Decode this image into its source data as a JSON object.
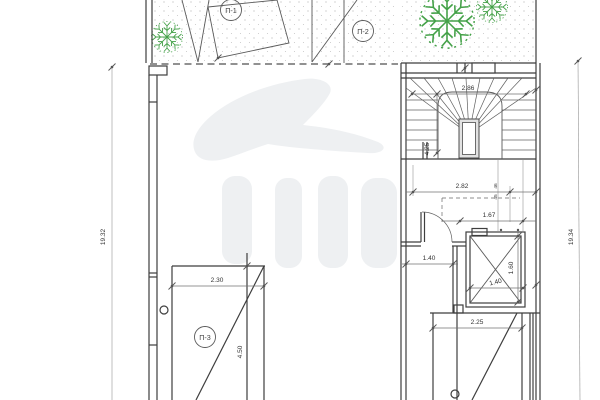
{
  "plan": {
    "title": "Architectural floor plan with winder stair, elevator shaft and garden areas",
    "labels": {
      "area1": "П-1",
      "area2": "П-2",
      "area3": "П-3"
    },
    "dims": {
      "stair_width": "2.86",
      "stair_length": "4.25",
      "lobby_width": "2.82",
      "lift_lobby": "1.67",
      "door_width": "1.40",
      "lift_width": "1.40",
      "lift_depth": "1.60",
      "bottom_width": "2.25",
      "terrace_width": "2.30",
      "terrace_length": "4.50",
      "left_total": "19.32",
      "right_total": "19.34",
      "small_upper": "46",
      "small_lower": "45"
    },
    "colors": {
      "wall": "#3e3e3e",
      "dimension": "#707070",
      "tree": "#44a148",
      "stipple_dots": "#bfbfbf",
      "watermark": "#eef0f2",
      "background": "#ffffff"
    }
  }
}
